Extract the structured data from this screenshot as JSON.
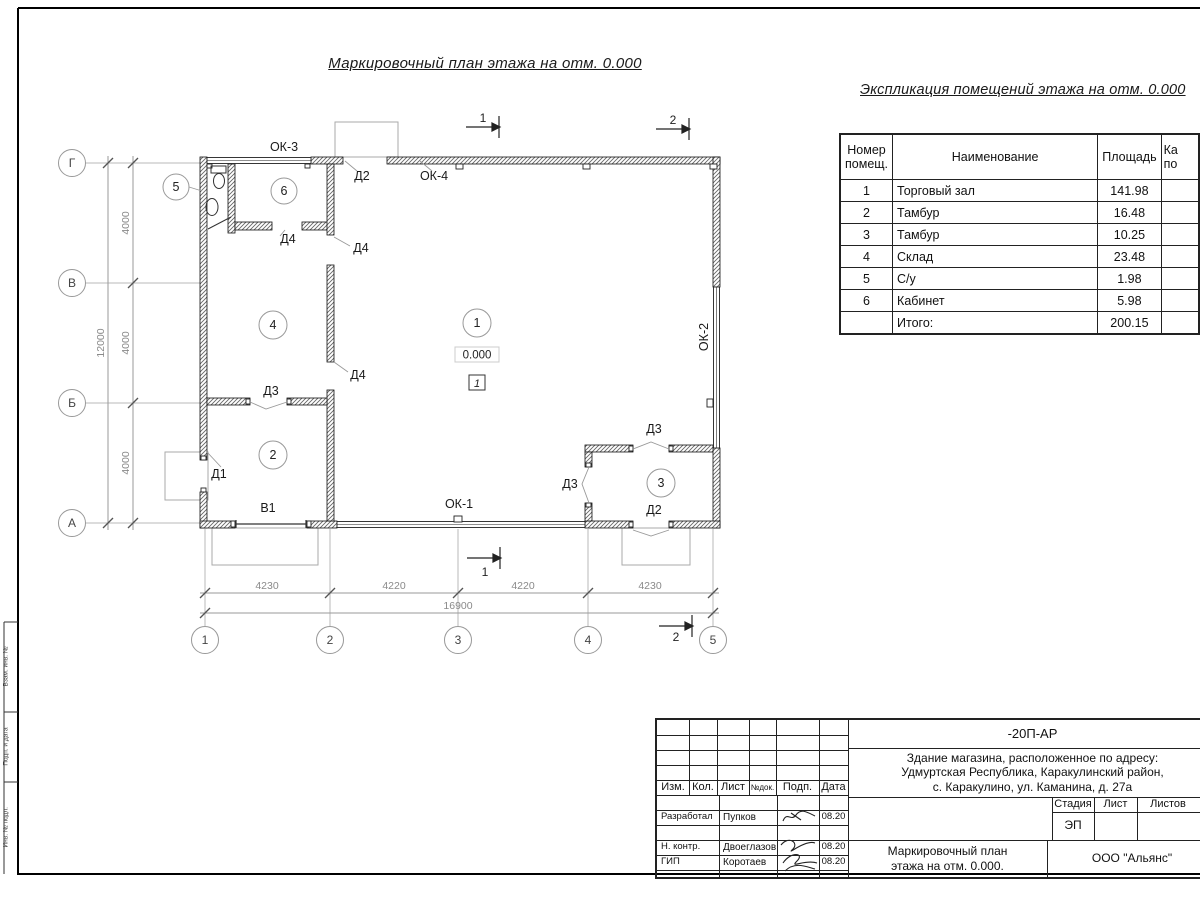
{
  "sheet": {
    "plan_title": "Маркировочный план этажа на отм. 0.000"
  },
  "plan": {
    "rooms": {
      "r1": "1",
      "r2": "2",
      "r3": "3",
      "r4": "4",
      "r5": "5",
      "r6": "6"
    },
    "elevation": "0.000",
    "floor_mark": "1",
    "windows": {
      "ok1": "ОК-1",
      "ok2": "ОК-2",
      "ok3": "ОК-3",
      "ok4": "ОК-4"
    },
    "doors": {
      "d1": "Д1",
      "d2": "Д2",
      "d3": "Д3",
      "d4": "Д4",
      "v1": "В1"
    },
    "axes": {
      "a": "А",
      "b": "Б",
      "v": "В",
      "g": "Г",
      "n1": "1",
      "n2": "2",
      "n3": "3",
      "n4": "4",
      "n5": "5"
    },
    "dims": {
      "d4000": "4000",
      "d12000": "12000",
      "d4230": "4230",
      "d4220": "4220",
      "d16900": "16900"
    },
    "sections": {
      "s1": "1",
      "s2": "2"
    }
  },
  "explication": {
    "title": "Экспликация помещений этажа на отм. 0.000",
    "col_number_line1": "Номер",
    "col_number_line2": "помещ.",
    "col_name": "Наименование",
    "col_area": "Площадь",
    "col_cat_line1": "Ка",
    "col_cat_line2": "по",
    "rows": [
      {
        "num": "1",
        "name": "Торговый зал",
        "area": "141.98"
      },
      {
        "num": "2",
        "name": "Тамбур",
        "area": "16.48"
      },
      {
        "num": "3",
        "name": "Тамбур",
        "area": "10.25"
      },
      {
        "num": "4",
        "name": "Склад",
        "area": "23.48"
      },
      {
        "num": "5",
        "name": "С/у",
        "area": "1.98"
      },
      {
        "num": "6",
        "name": "Кабинет",
        "area": "5.98"
      },
      {
        "num": "",
        "name": "Итого:",
        "area": "200.15"
      }
    ]
  },
  "title_block": {
    "doc_number": "-20П-АР",
    "address1": "Здание магазина, расположенное по адресу:",
    "address2": "Удмуртская Республика, Каракулинский район,",
    "address3": "с. Каракулино, ул. Каманина, д. 27а",
    "col_izm": "Изм.",
    "col_kol": "Кол.",
    "col_list": "Лист",
    "col_ndok": "№док.",
    "col_podp": "Подп.",
    "col_data": "Дата",
    "row_dev_role": "Разработал",
    "row_dev_name": "Пупков",
    "row_dev_date": "08.20",
    "row_ncontr_role": "Н. контр.",
    "row_ncontr_name": "Двоеглазов",
    "row_ncontr_date": "08.20",
    "row_gip_role": "ГИП",
    "row_gip_name": "Коротаев",
    "row_gip_date": "08.20",
    "stage_label": "Стадия",
    "list_label": "Лист",
    "listov_label": "Листов",
    "stage_value": "ЭП",
    "name_line1": "Маркировочный план",
    "name_line2": "этажа на отм. 0.000.",
    "company": "ООО \"Альянс\""
  },
  "margin_labels": {
    "m1": "Взам. инв. №",
    "m2": "Подп. и дата",
    "m3": "Инв. № подл."
  }
}
